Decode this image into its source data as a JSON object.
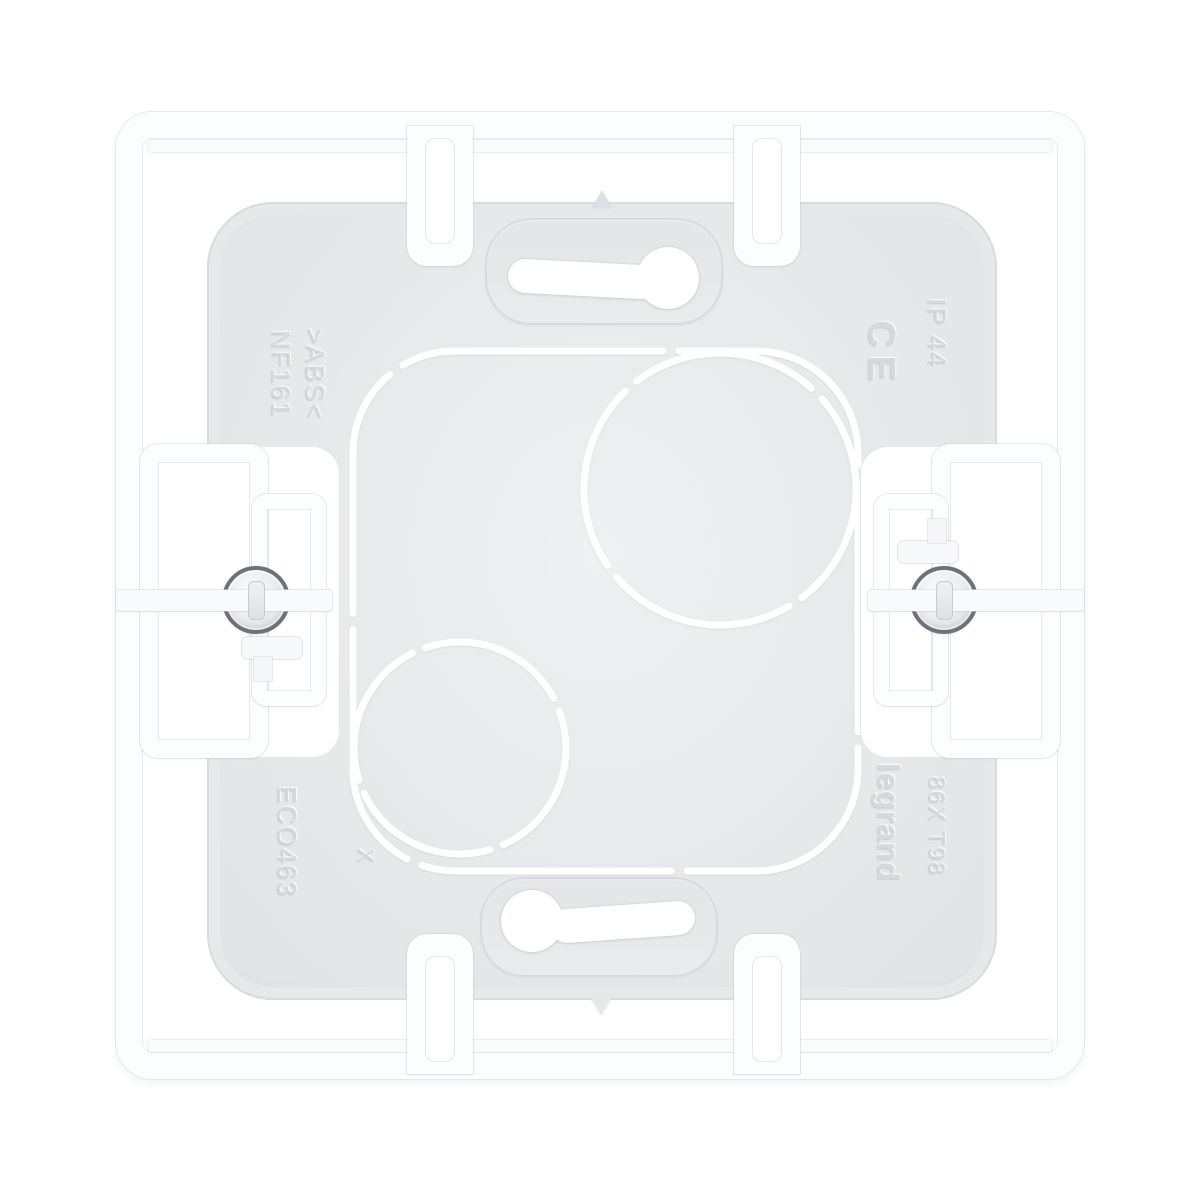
{
  "image": {
    "type": "product-photo",
    "subject": "Rear view of a white plastic wall-mounting box frame with grey base plate, two fixing screws, keyhole slots and knockout outlines",
    "background_color": "#ffffff"
  },
  "markings": {
    "standard": "NF161",
    "material": ">ABS<",
    "certification": "CE",
    "protection_rating": "IP 44",
    "mold_code": "ECO463",
    "mold_mark": "X",
    "brand": "legrand",
    "reference_code": "86X T98"
  },
  "colors": {
    "background": "#ffffff",
    "plastic_white": "#fcfdfe",
    "plate_gray": "#e6e8ea",
    "screw_ring_gray": "#6e7276",
    "emboss_gray": "#d6d9db",
    "knockout_line": "#ffffff"
  }
}
